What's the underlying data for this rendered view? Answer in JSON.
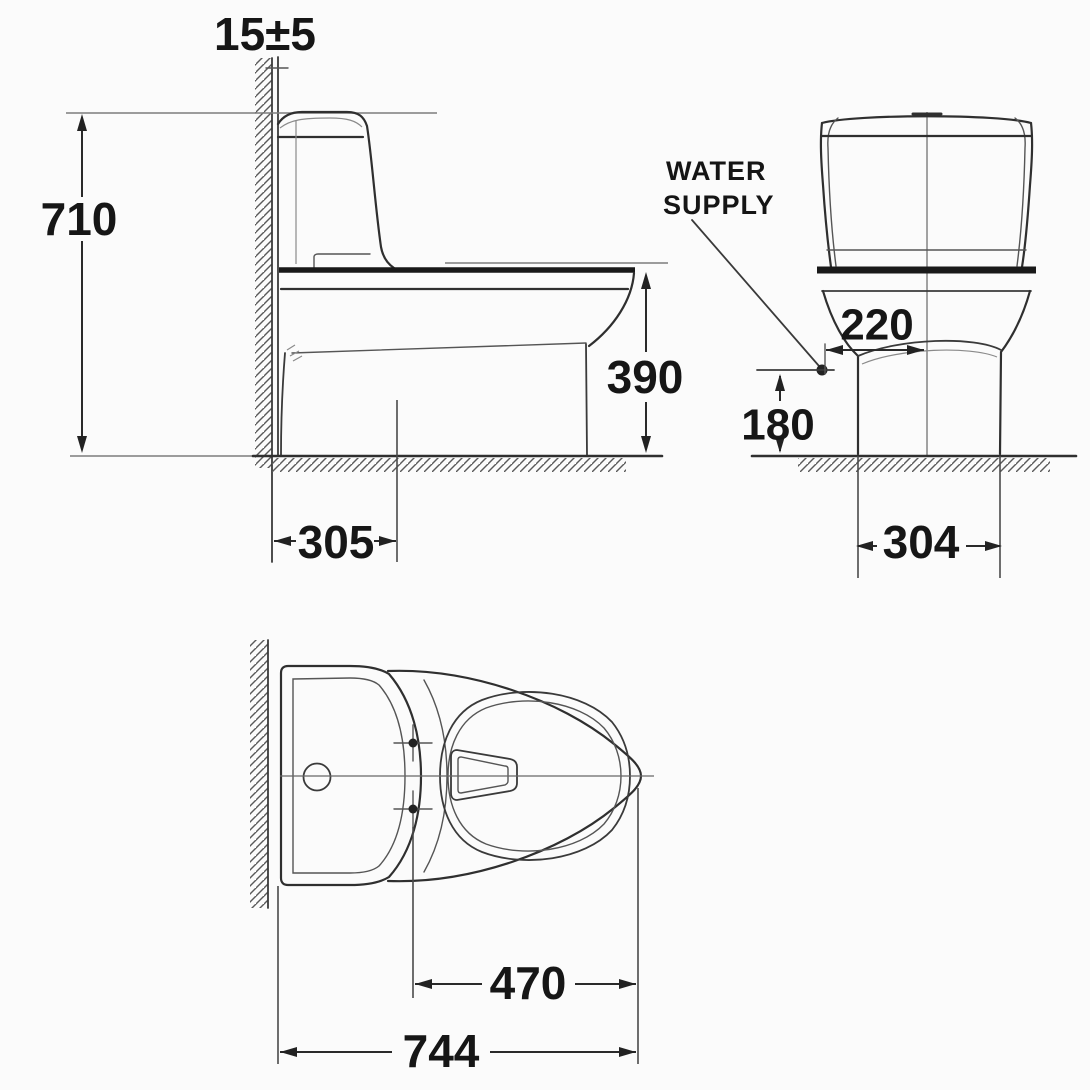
{
  "drawing": {
    "kind": "toilet-dimension-technical-drawing",
    "views": [
      "side-view",
      "front-view",
      "top-view"
    ]
  },
  "labels": {
    "water_supply_line1": "WATER",
    "water_supply_line2": "SUPPLY"
  },
  "side_view": {
    "wall_clearance": "15±5",
    "overall_height": "710",
    "rim_height": "390",
    "outlet_from_wall": "305"
  },
  "front_view": {
    "supply_offset_from_center": "220",
    "supply_height": "180",
    "base_width": "304"
  },
  "top_view": {
    "bolt_line_to_front": "470",
    "overall_depth": "744"
  },
  "colors": {
    "background": "#fbfbfb",
    "line": "#2f2f2f",
    "heavy_line": "#191919",
    "thin_line": "#6e6e6e",
    "text": "#161616"
  }
}
